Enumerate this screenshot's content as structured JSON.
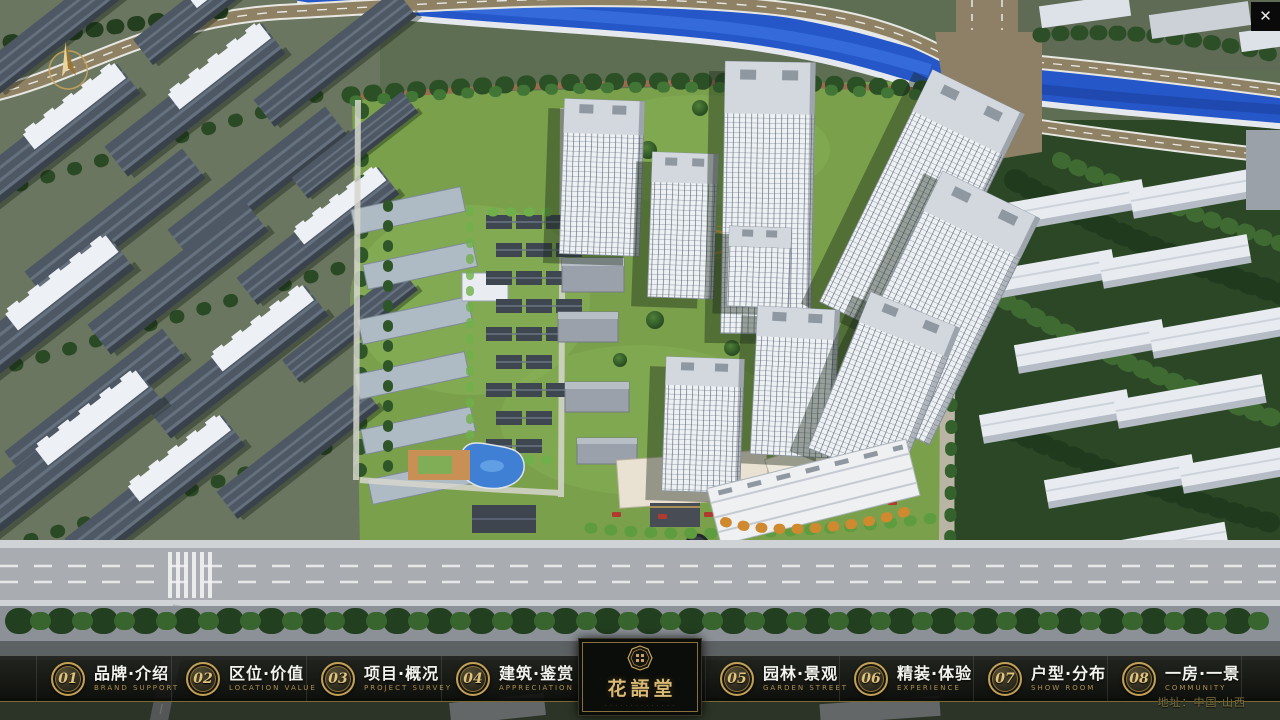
{
  "window": {
    "close_glyph": "✕"
  },
  "nav": {
    "items": [
      {
        "number": "01",
        "zh": "品牌·介绍",
        "en": "BRAND SUPPORT"
      },
      {
        "number": "02",
        "zh": "区位·价值",
        "en": "LOCATION VALUE"
      },
      {
        "number": "03",
        "zh": "项目·概况",
        "en": "PROJECT SURVEY"
      },
      {
        "number": "04",
        "zh": "建筑·鉴赏",
        "en": "APPRECIATION"
      },
      {
        "number": "05",
        "zh": "园林·景观",
        "en": "GARDEN STREET"
      },
      {
        "number": "06",
        "zh": "精装·体验",
        "en": "EXPERIENCE"
      },
      {
        "number": "07",
        "zh": "户型·分布",
        "en": "SHOW ROOM"
      },
      {
        "number": "08",
        "zh": "一房·一景",
        "en": "COMMUNITY"
      }
    ]
  },
  "logo": {
    "name": "花語堂",
    "tagline": "· · · · · · · · · · · · · ·"
  },
  "footer": {
    "address": "地址：中国·山西"
  },
  "colors": {
    "gold": "#c9a45a",
    "bar_background": "#101210",
    "river_blue": "#2557c9",
    "lawn_green": "#7aa24d",
    "tree_green": "#2d5229",
    "road_gray": "#a9adb2",
    "tower_white": "#eef1f4"
  }
}
